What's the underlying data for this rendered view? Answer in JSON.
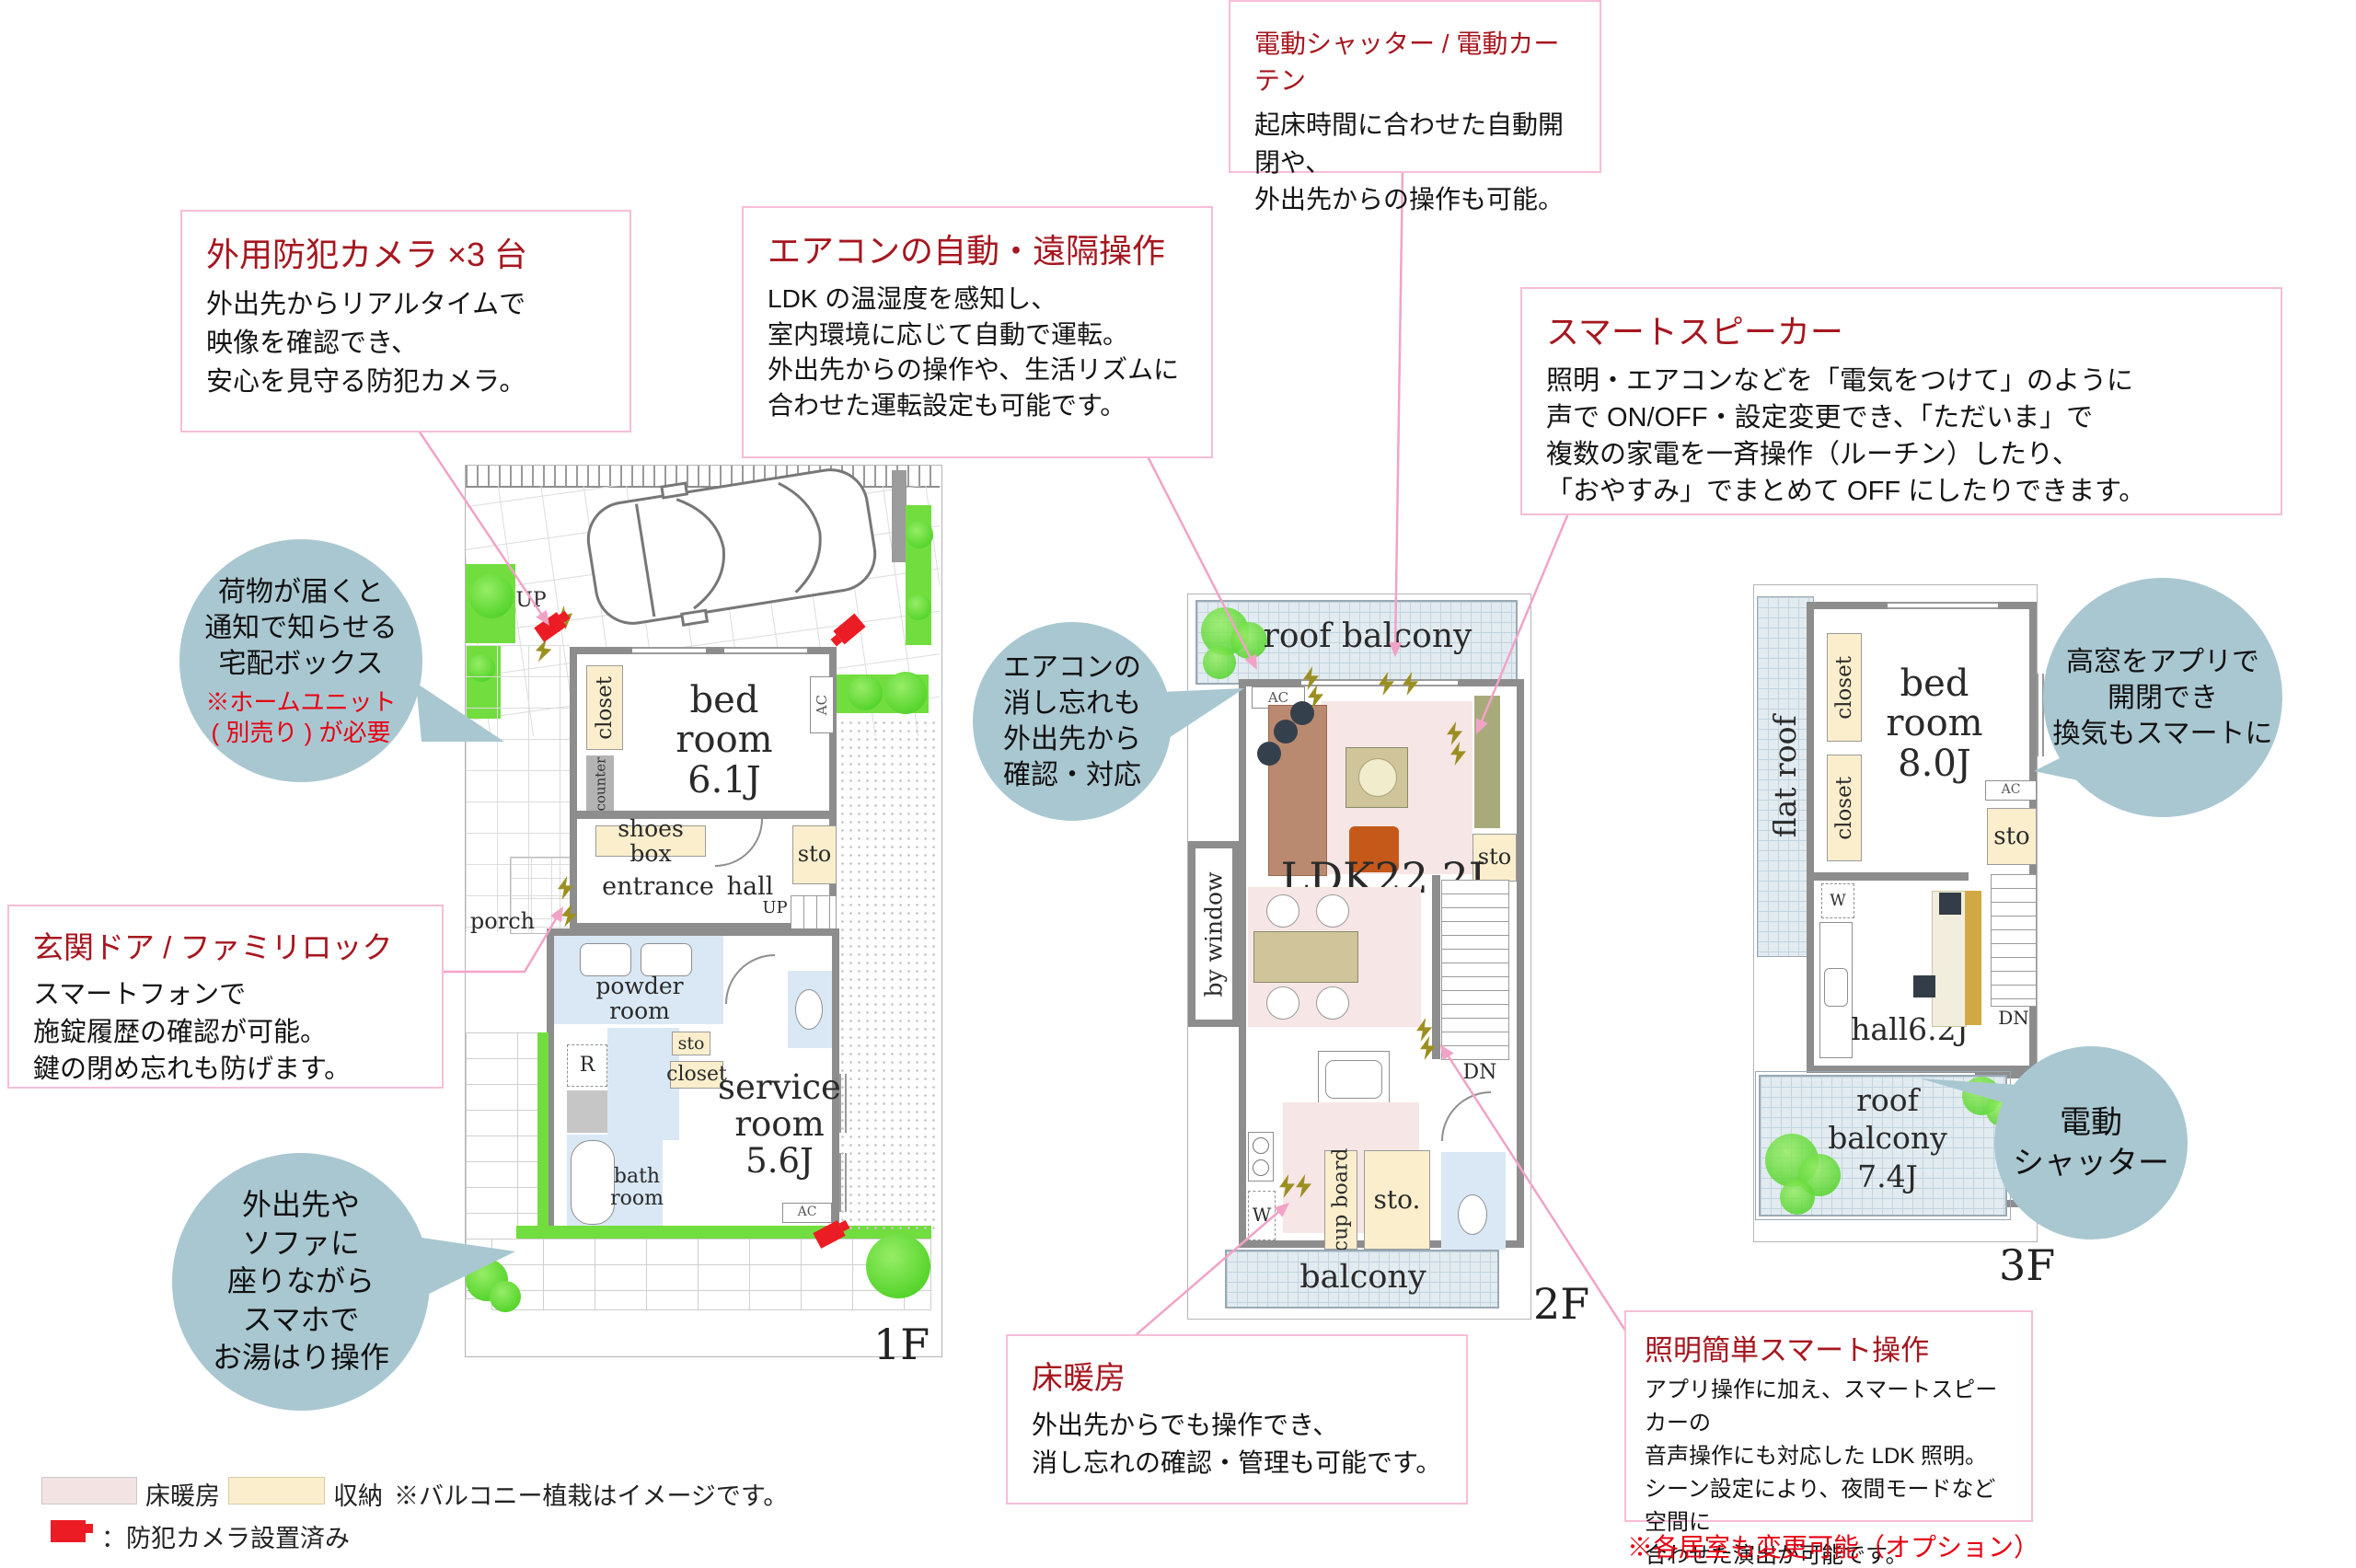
{
  "callouts": {
    "shutter": {
      "title": "電動シャッター / 電動カーテン",
      "body": "起床時間に合わせた自動開閉や、\n外出先からの操作も可能。"
    },
    "camera": {
      "title": "外用防犯カメラ ×3 台",
      "body": "外出先からリアルタイムで\n映像を確認でき、\n安心を見守る防犯カメラ。"
    },
    "aircon": {
      "title": "エアコンの自動・遠隔操作",
      "body": "LDK の温湿度を感知し、\n室内環境に応じて自動で運転。\n外出先からの操作や、生活リズムに\n合わせた運転設定も可能です。"
    },
    "speaker": {
      "title": "スマートスピーカー",
      "body": "照明・エアコンなどを「電気をつけて」のように\n声で ON/OFF・設定変更でき、「ただいま」で\n複数の家電を一斉操作（ルーチン）したり、\n「おやすみ」でまとめて OFF にしたりできます。"
    },
    "door": {
      "title": "玄関ドア / ファミリロック",
      "body": "スマートフォンで\n施錠履歴の確認が可能。\n鍵の閉め忘れも防げます。"
    },
    "floorheat": {
      "title": "床暖房",
      "body": "外出先からでも操作でき、\n消し忘れの確認・管理も可能です。"
    },
    "lighting": {
      "title": "照明簡単スマート操作",
      "body": "アプリ操作に加え、スマートスピーカーの\n音声操作にも対応した LDK 照明。\nシーン設定により、夜間モードなど空間に\n合わせた演出が可能です。",
      "note": "※各居室も変更可能（オプション）"
    }
  },
  "bubbles": {
    "delivery": {
      "text": "荷物が届くと\n通知で知らせる\n宅配ボックス",
      "note": "※ホームユニット\n( 別売り ) が必要"
    },
    "bathfill": {
      "text": "外出先や\nソファに\n座りながら\nスマホで\nお湯はり操作"
    },
    "airconoff": {
      "text": "エアコンの\n消し忘れも\n外出先から\n確認・対応"
    },
    "highwindow": {
      "text": "高窓をアプリで\n開閉でき\n換気もスマートに"
    },
    "eshutter": {
      "text": "電動\nシャッター"
    }
  },
  "plan1f": {
    "floor": "1F",
    "up1": "UP",
    "up2": "UP",
    "closet1": "closet",
    "counter": "counter",
    "bedroom": "bed\nroom\n6.1J",
    "ac1": "AC",
    "shoesbox": "shoes box",
    "sto1": "sto",
    "entrance": "entrance",
    "hall": "hall",
    "porch": "porch",
    "powder": "powder\nroom",
    "r": "R",
    "sto2": "sto",
    "closet2": "closet",
    "service": "service\nroom\n5.6J",
    "ac2": "AC",
    "bath": "bath\nroom"
  },
  "plan2f": {
    "floor": "2F",
    "roofbalcony": "roof balcony",
    "ac": "AC",
    "ldk": "LDK22.2J",
    "bywindow": "by window",
    "sto1": "sto",
    "dn": "DN",
    "w": "W",
    "cupboard": "cup board",
    "sto2": "sto.",
    "balcony": "balcony"
  },
  "plan3f": {
    "floor": "3F",
    "flatroof": "flat roof",
    "closet1": "closet",
    "closet2": "closet",
    "bedroom": "bed\nroom\n8.0J",
    "ac": "AC",
    "sto": "sto",
    "w": "W",
    "hall": "hall6.2J",
    "dn": "DN",
    "roofbalcony": "roof balcony\n7.4J"
  },
  "legend": {
    "floorheat": "床暖房",
    "storage": "収納",
    "note": "※バルコニー植栽はイメージです。",
    "camera": "：防犯カメラ設置済み"
  },
  "colors": {
    "accent_red": "#a6161f",
    "note_red": "#e60012",
    "pink_border": "#f6bdd6",
    "bubble_blue": "#a9c7d1",
    "storage_cream": "#faeecd",
    "floorheat_pink": "#f7e6e6"
  }
}
